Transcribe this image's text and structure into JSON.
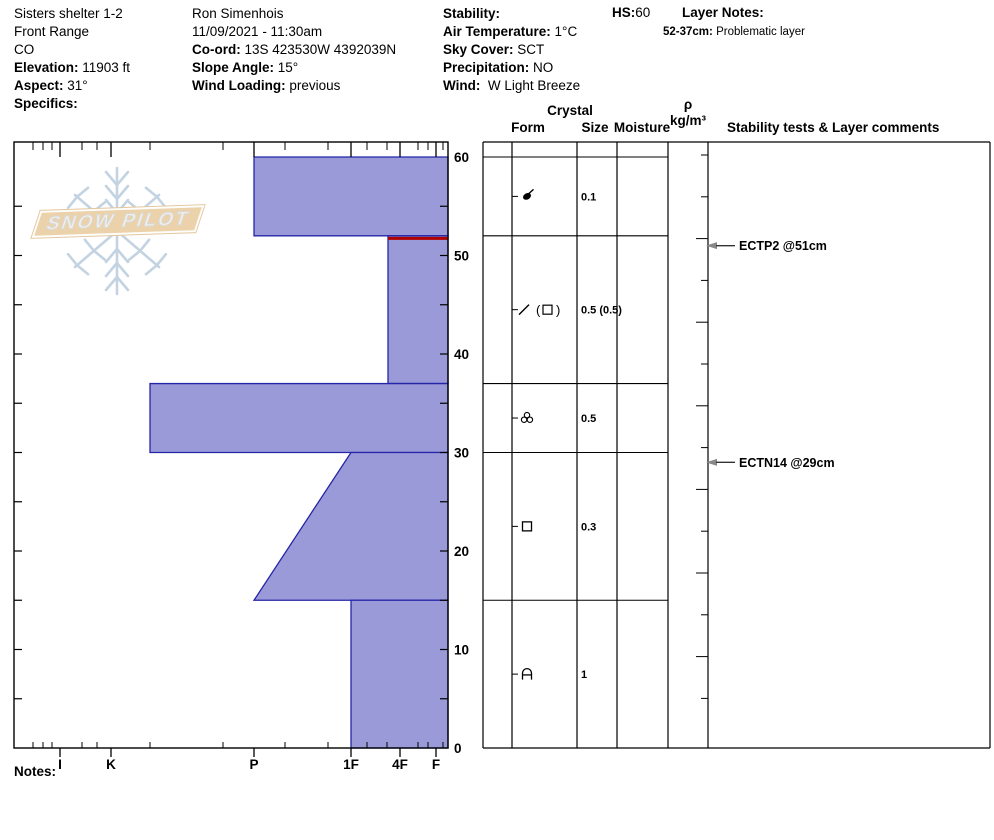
{
  "header": {
    "columns": [
      {
        "lines": [
          {
            "label": "",
            "value": "Sisters shelter 1-2"
          },
          {
            "label": "",
            "value": "Front Range"
          },
          {
            "label": "",
            "value": "CO"
          },
          {
            "label": "Elevation:",
            "value": "11903 ft"
          },
          {
            "label": "Aspect:",
            "value": "31°"
          },
          {
            "label": "Specifics:",
            "value": ""
          }
        ]
      },
      {
        "lines": [
          {
            "label": "",
            "value": "Ron Simenhois"
          },
          {
            "label": "",
            "value": "11/09/2021 - 11:30am"
          },
          {
            "label": "Co-ord:",
            "value": "13S 423530W 4392039N"
          },
          {
            "label": "Slope Angle:",
            "value": "15°"
          },
          {
            "label": "Wind Loading:",
            "value": "previous"
          }
        ]
      },
      {
        "lines": [
          {
            "label": "Stability:",
            "value": ""
          },
          {
            "label": "Air Temperature:",
            "value": "1°C"
          },
          {
            "label": "Sky Cover:",
            "value": "SCT"
          },
          {
            "label": "Precipitation:",
            "value": "NO"
          },
          {
            "label": "Wind:",
            "value": " W Light Breeze"
          }
        ]
      }
    ],
    "hs": {
      "label": "HS:",
      "value": "60"
    },
    "layer_notes": {
      "title": "Layer Notes:",
      "entries": [
        {
          "range": "52-37cm:",
          "text": "Problematic layer"
        }
      ]
    }
  },
  "logo": {
    "text": "SNOW PILOT"
  },
  "table_headers": {
    "crystal": "Crystal",
    "form": "Form",
    "size": "Size",
    "moisture": "Moisture",
    "density_symbol": "ρ",
    "density_units": "kg/m³",
    "stability": "Stability tests & Layer comments"
  },
  "notes": {
    "label": "Notes:"
  },
  "chart_data": {
    "type": "bar",
    "subtype": "snow-hardness-profile",
    "title": "Snow hardness profile (hardness vs depth)",
    "depth_axis": {
      "unit": "cm",
      "range": [
        0,
        60
      ],
      "major_tick_labels": [
        60,
        50,
        40,
        30,
        20,
        10,
        0
      ],
      "minor_tick_every_cm": 5
    },
    "hardness_axis": {
      "labels": [
        "I",
        "K",
        "P",
        "1F",
        "4F",
        "F"
      ],
      "order": "hard-to-soft-left-to-right"
    },
    "total_height_cm": 60,
    "layers": [
      {
        "top_cm": 60,
        "bottom_cm": 52,
        "hardness": "P",
        "form": "DF",
        "size_mm": "0.1"
      },
      {
        "top_cm": 52,
        "bottom_cm": 37,
        "hardness": "4F+",
        "form": "DF(FC)",
        "size_mm": "0.5 (0.5)",
        "flagged_red": true
      },
      {
        "top_cm": 37,
        "bottom_cm": 30,
        "hardness": "P-K",
        "form": "MF",
        "size_mm": "0.5"
      },
      {
        "top_cm": 30,
        "bottom_cm": 15,
        "hardness_top": "1F",
        "hardness_bottom": "P",
        "form": "FC",
        "size_mm": "0.3"
      },
      {
        "top_cm": 15,
        "bottom_cm": 0,
        "hardness": "1F",
        "form": "DH",
        "size_mm": "1"
      }
    ],
    "stability_tests": [
      {
        "label": "ECTP2 @51cm",
        "depth_cm": 51
      },
      {
        "label": "ECTN14 @29cm",
        "depth_cm": 29
      }
    ]
  },
  "colors": {
    "bar_fill": "#9a9ad8",
    "bar_stroke": "#2525a8",
    "red_layer": "#b00000",
    "grid": "#000000",
    "logo_band": "#ecd2ab",
    "snowflake": "#c3d3e2",
    "arrow": "#888888"
  }
}
